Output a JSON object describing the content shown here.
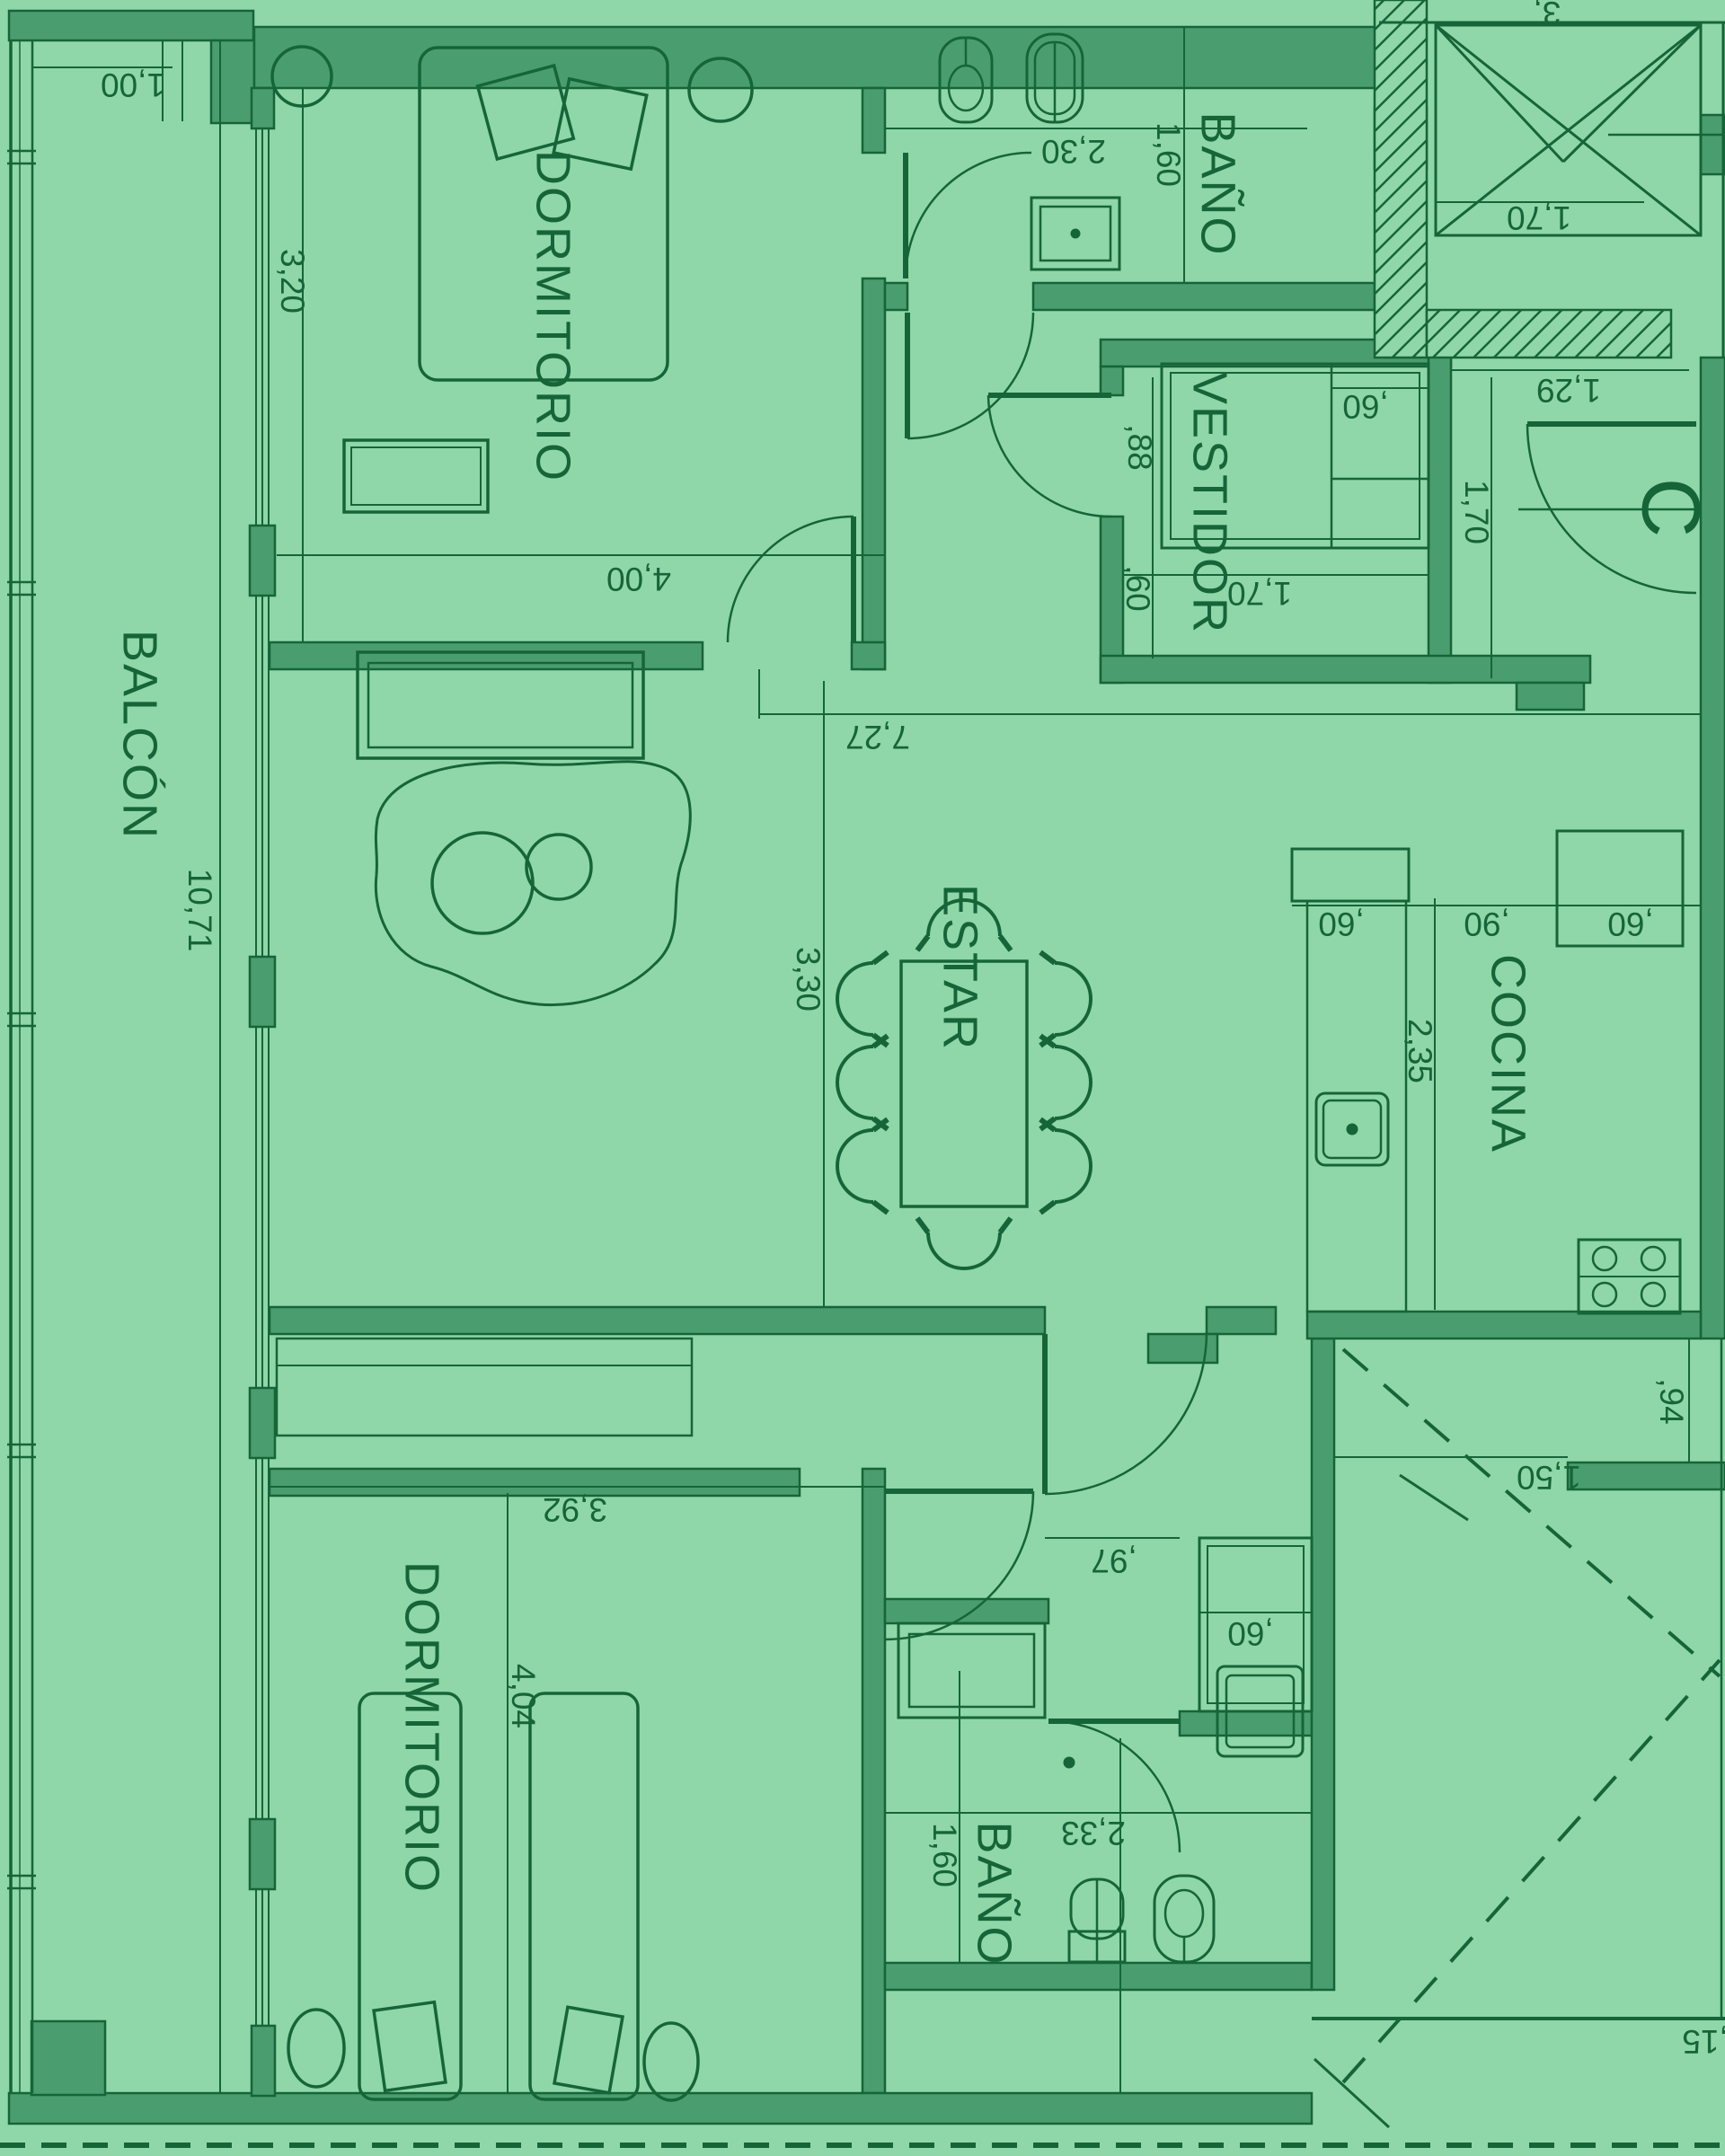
{
  "title": "Apartment unit C floor plan",
  "colors": {
    "background": "#8FD7A8",
    "wall_fill": "#4A9D6F",
    "line": "#166539"
  },
  "texts": {
    "rooms": {
      "balcon": "BALCÓN",
      "dormitorio_top": "DORMITORIO",
      "bano_top": "BAÑO",
      "vestidor": "VESTIDOR",
      "estar": "ESTAR",
      "cocina": "COCINA",
      "dormitorio_bottom": "DORMITORIO",
      "bano_bottom": "BAÑO",
      "unit": "C"
    },
    "dims": {
      "d_1_00": "1,00",
      "d_3_20": "3,20",
      "d_10_71": "10,71",
      "d_2_30": "2,30",
      "d_1_60_top": "1,60",
      "d_4_00": "4,00",
      "d_7_27": "7,27",
      "d_88": ",88",
      "d_60_vestidor_left": ",60",
      "d_60_vestidor_closet": ",60",
      "d_1_29": "1,29",
      "d_1_70_entry": "1,70",
      "d_1_70_vestidor": "1,70",
      "d_1_70_stair": "1,70",
      "d_3_top": "3,",
      "d_3_30": "3,30",
      "d_2_35": "2,35",
      "d_60_kitchen_left": ",60",
      "d_90": ",90",
      "d_60_kitchen_right": ",60",
      "d_3_92": "3,92",
      "d_4_04": "4,04",
      "d_97": ",97",
      "d_60_closet": ",60",
      "d_1_60_bottom": "1,60",
      "d_2_33": "2,33",
      "d_1_50": "1,50",
      "d_94": ",94",
      "d_15": ",15"
    }
  }
}
